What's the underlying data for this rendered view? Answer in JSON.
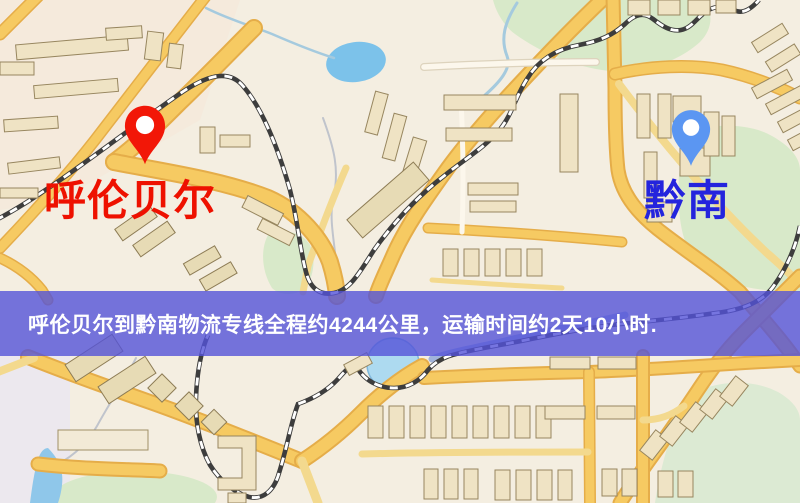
{
  "route_map": {
    "origin": {
      "name": "呼伦贝尔"
    },
    "destination": {
      "name": "黔南"
    },
    "banner": {
      "text": "呼伦贝尔到黔南物流专线全程约4244公里，运输时间约2天10小时."
    },
    "colors": {
      "map_background": "#f4eee1",
      "origin_label": "#ee1100",
      "origin_pin": "#f21707",
      "destination_label": "#2424dd",
      "destination_pin": "#5b96f2",
      "banner_background": "rgba(84,82,216,0.8)",
      "banner_text": "#ffffff",
      "road_major": "#f6ca62",
      "road_casing": "#e5ad49",
      "water": "#8fc7ea",
      "green": "#d8e9c9",
      "railway_dark": "#3d3d3d"
    }
  }
}
